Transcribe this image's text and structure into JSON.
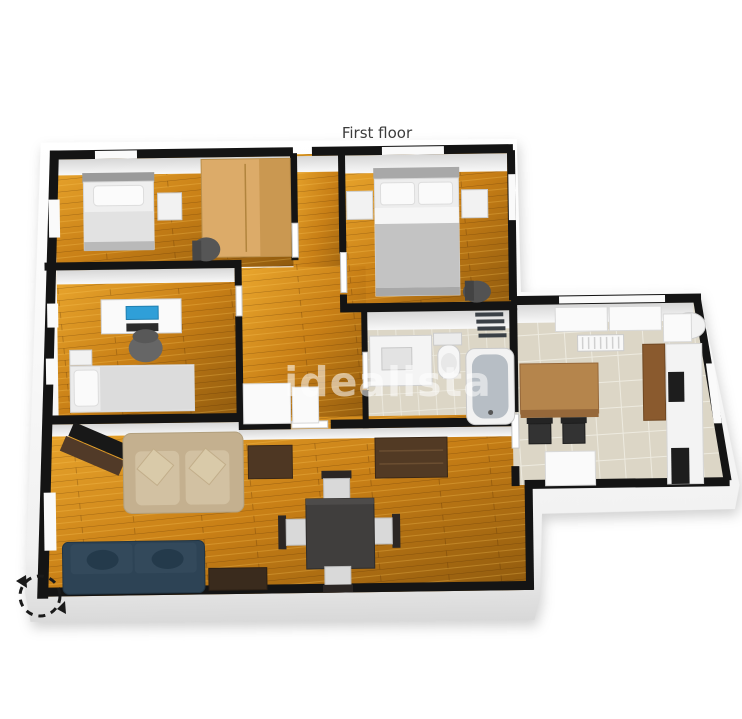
{
  "title": {
    "text": "First floor"
  },
  "watermark": {
    "text": "idealista"
  },
  "palette": {
    "wall-cap": "#141414",
    "wall-face": "#f5f5f5",
    "wall-face-shade": "#d9d9d9",
    "wood-1": "#8f5a0e",
    "wood-2": "#c87f16",
    "wood-3": "#eaa72e",
    "tile": "#dcd6c6",
    "tile-grout": "#edeadf",
    "wardrobe-wood": "#dcab69",
    "wardrobe-wood-dark": "#c08d45",
    "sofa-beige": "#c4b08f",
    "sofa-beige-light": "#d2c1a2",
    "sofa-navy": "#2d4355",
    "sofa-navy-dark": "#243a4b",
    "dark-wood": "#4e3723",
    "table-dark": "#403e3d",
    "screen-blue": "#2f9fd8",
    "chair-gray": "#666666",
    "tub-inner": "#b7bec5",
    "ladder-dark": "#3a4046",
    "kitchen-wood": "#b5854c",
    "cabinet-wood": "#8a5a2e",
    "appliance-dark": "#1d1d1d",
    "icon-dark": "#1a1a1a"
  },
  "floor_plan": {
    "view": "3d-isometric-top-view",
    "rooms": [
      {
        "name": "bedroom-1",
        "floor": "wood",
        "furniture": [
          "single-bed",
          "wardrobe",
          "nightstand",
          "desk-chair"
        ]
      },
      {
        "name": "master-bedroom",
        "floor": "wood",
        "furniture": [
          "double-bed",
          "nightstand-left",
          "nightstand-right",
          "chair"
        ]
      },
      {
        "name": "office-bedroom",
        "floor": "wood",
        "furniture": [
          "desk",
          "monitor",
          "office-chair",
          "single-bed",
          "nightstand"
        ]
      },
      {
        "name": "hallway",
        "floor": "wood",
        "furniture": [
          "closet",
          "closet-small"
        ]
      },
      {
        "name": "bathroom",
        "floor": "tile",
        "furniture": [
          "vanity-sink",
          "toilet",
          "bathtub",
          "towel-ladder"
        ]
      },
      {
        "name": "living-dining-room",
        "floor": "wood",
        "furniture": [
          "tv-on-stand",
          "beige-sofa",
          "navy-sofa",
          "coffee-table",
          "side-cabinet",
          "sideboard",
          "dining-table",
          "dining-chairs-x4"
        ]
      },
      {
        "name": "kitchen",
        "floor": "tile",
        "furniture": [
          "wood-table",
          "chairs-x2",
          "radiator",
          "window-panels",
          "boiler",
          "tall-cabinet",
          "counter-run",
          "oven",
          "appliance",
          "island-unit"
        ]
      }
    ]
  },
  "controls": {
    "rotate_icon": "dashed-circular-rotate-arrow"
  }
}
